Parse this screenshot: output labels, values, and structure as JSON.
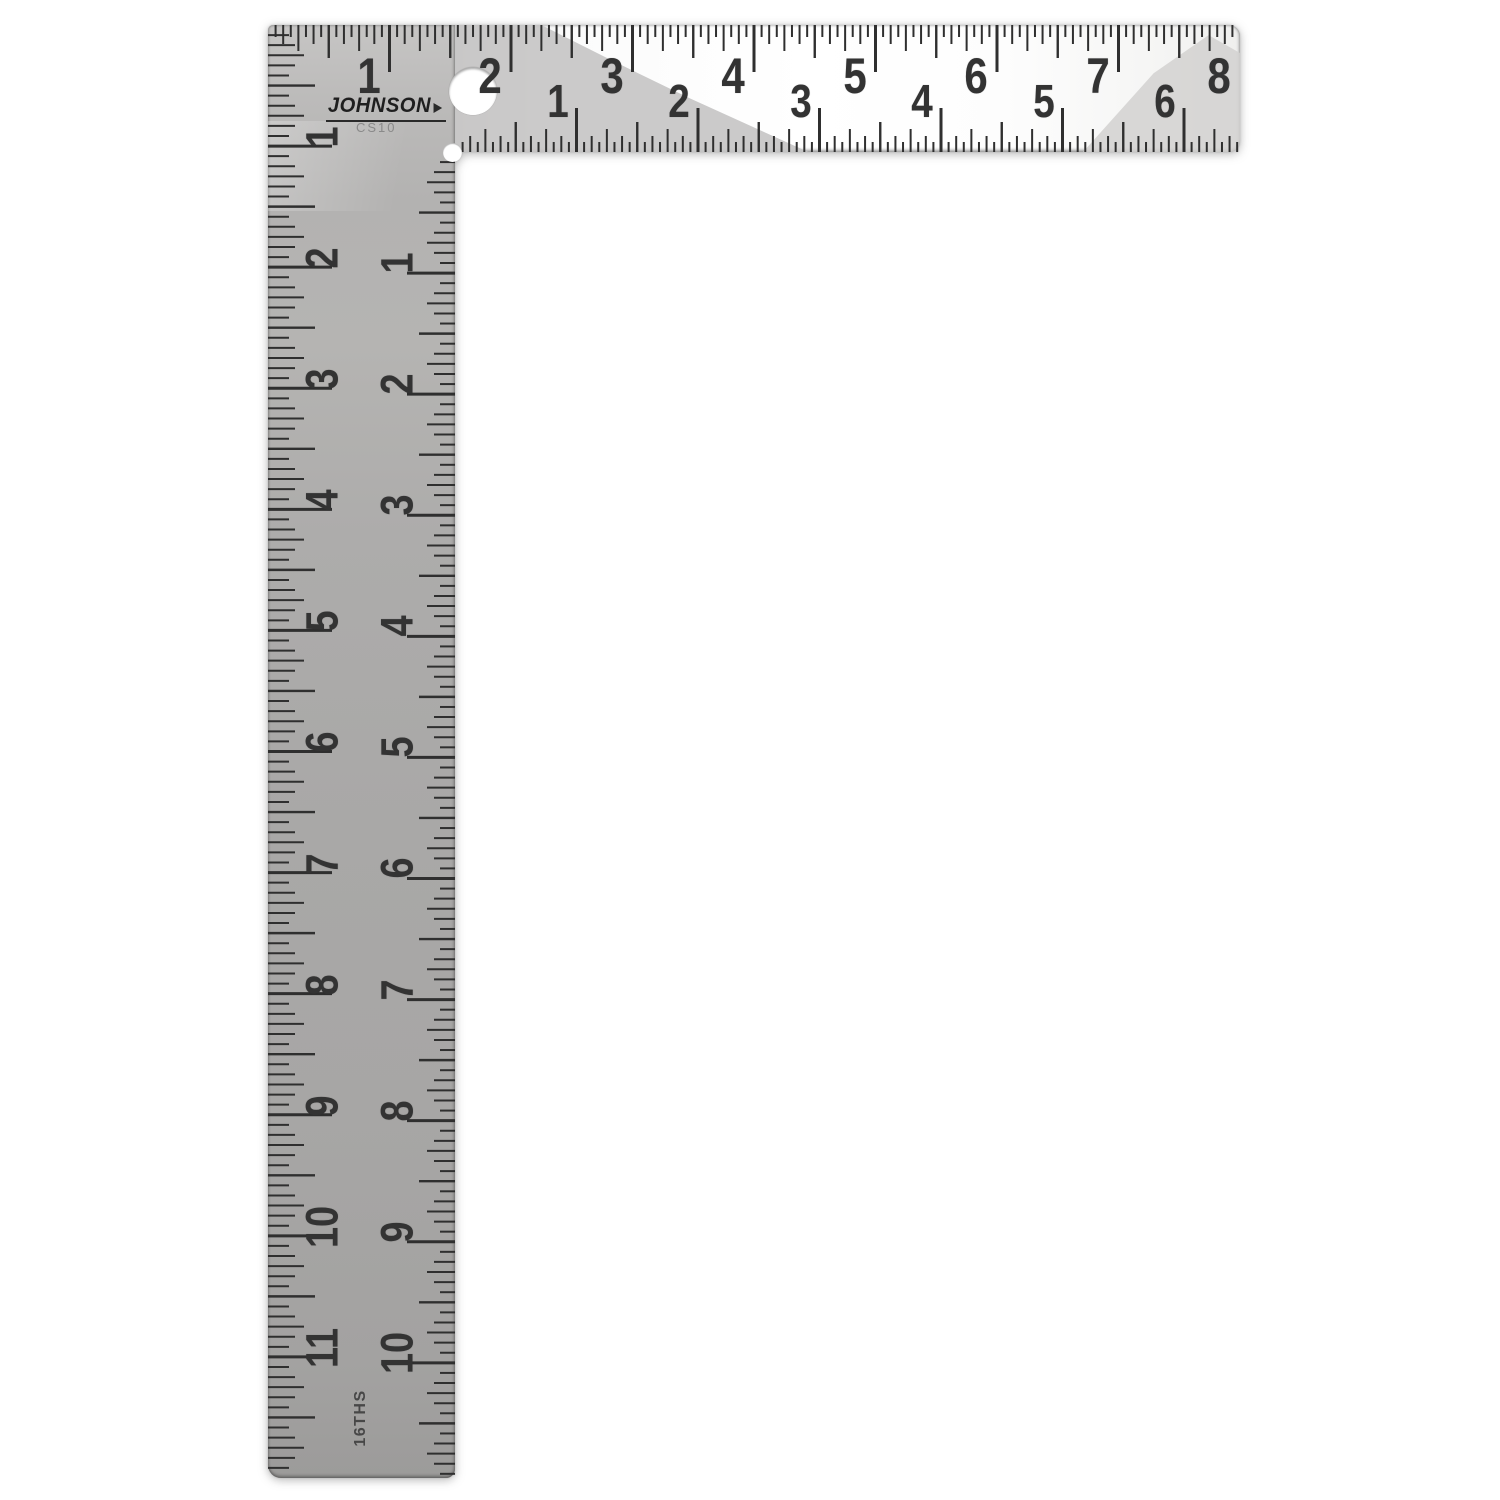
{
  "product": {
    "brand": "JOHNSON",
    "model": "CS10",
    "graduation_stamp": "16THS"
  },
  "scales": {
    "tongue_outer": {
      "edge": "top",
      "numbers": [
        "1",
        "2",
        "3",
        "4",
        "5",
        "6",
        "7",
        "8"
      ],
      "divisions_per_inch": 16
    },
    "tongue_inner": {
      "edge": "bottom",
      "numbers": [
        "1",
        "2",
        "3",
        "4",
        "5",
        "6"
      ],
      "divisions_per_inch": 16
    },
    "blade_outer": {
      "edge": "left",
      "numbers": [
        "1",
        "2",
        "3",
        "4",
        "5",
        "6",
        "7",
        "8",
        "9",
        "10",
        "11"
      ],
      "divisions_per_inch": 12
    },
    "blade_inner": {
      "edge": "right",
      "numbers": [
        "1",
        "2",
        "3",
        "4",
        "5",
        "6",
        "7",
        "8",
        "9",
        "10"
      ],
      "divisions_per_inch": 12
    }
  },
  "colors": {
    "background": "#ffffff",
    "blade_metal": "#ababab",
    "tongue_metal": "#fbfbfb",
    "tick": "#2f2f2f",
    "numeral": "#333333",
    "model_text": "#8a8a8a"
  }
}
